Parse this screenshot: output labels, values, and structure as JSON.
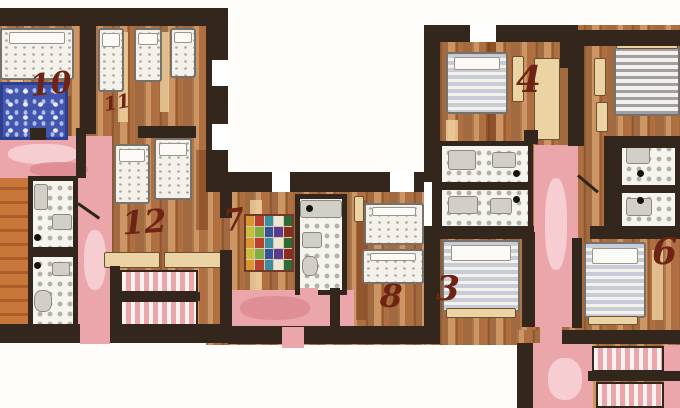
{
  "plan": {
    "type": "hand-painted apartment floor plan",
    "rooms": [
      {
        "id": "room-10",
        "label": "10"
      },
      {
        "id": "room-11",
        "label": "11"
      },
      {
        "id": "room-12",
        "label": "12"
      },
      {
        "id": "room-7",
        "label": "7"
      },
      {
        "id": "room-8",
        "label": "8"
      },
      {
        "id": "room-3",
        "label": "3"
      },
      {
        "id": "room-4",
        "label": "4"
      },
      {
        "id": "room-6",
        "label": "6"
      }
    ],
    "colors": {
      "wall": "#32261d",
      "wood_base": "#b97c4e",
      "pink": "#eba6ab",
      "pink_light": "#f7d3d6",
      "pink_dark": "#dd8890",
      "tile_bg": "#f6f4ee",
      "bed": "#f3f1ea",
      "beige": "#ecd3a4",
      "rug_blue": "#4156ac",
      "label": "#6e2414"
    },
    "room7_rug_palette": [
      "#b8402f",
      "#2f6b35",
      "#34519e",
      "#d9952f",
      "#efe6d2",
      "#7fae3f",
      "#8c2b20",
      "#3a8ea0",
      "#c9c03a",
      "#5a3b8e"
    ]
  }
}
